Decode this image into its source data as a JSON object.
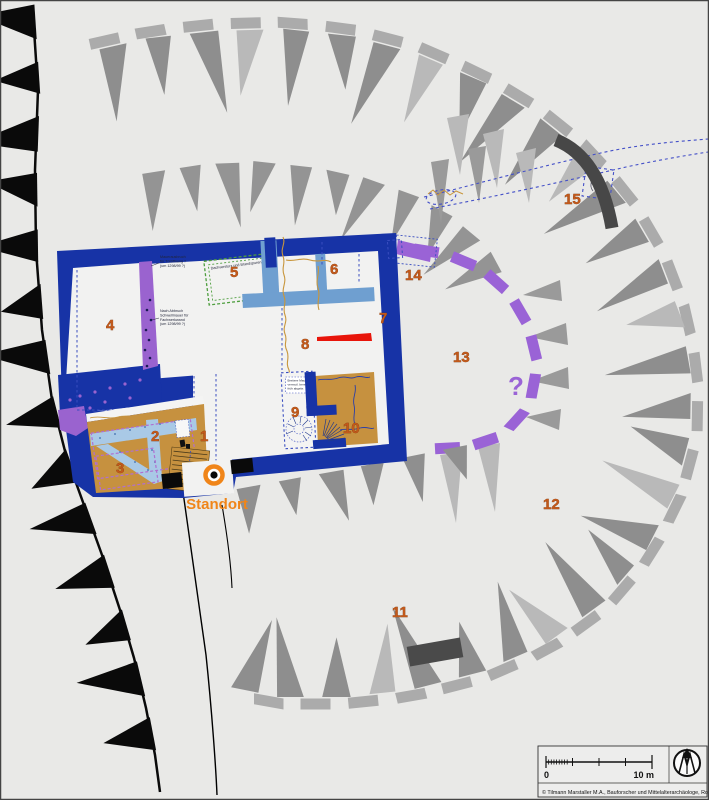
{
  "map": {
    "background_color": "#e9e9e7",
    "colors": {
      "building_wall": "#1733a6",
      "secondary_wall": "#6f9fd0",
      "light_masonry": "#a9c9e6",
      "timber_floor": "#c6913f",
      "phase_purple": "#9a63cf",
      "ring_dash_purple": "#9a63d6",
      "red_feature": "#e8150a",
      "label_orange": "#c2591b",
      "standort_orange": "#f08519",
      "rampart_dash": "#ababab",
      "rampart_spike": "#8e8e8e",
      "rampart_spike_light": "#b9b9b9",
      "cliff_black": "#0a0a0a",
      "dark_wall_segment": "#474747",
      "trench_blue_dash": "#3a4ec0",
      "green_outline": "#4e9e3e",
      "old_wall_ochre": "#c8963c"
    },
    "area_labels": [
      {
        "label": "1"
      },
      {
        "label": "2"
      },
      {
        "label": "3"
      },
      {
        "label": "4"
      },
      {
        "label": "5"
      },
      {
        "label": "6"
      },
      {
        "label": "7"
      },
      {
        "label": "8"
      },
      {
        "label": "9"
      },
      {
        "label": "10"
      },
      {
        "label": "11"
      },
      {
        "label": "12"
      },
      {
        "label": "13"
      },
      {
        "label": "14"
      },
      {
        "label": "15"
      }
    ],
    "question_mark": "?",
    "standort_label": "Standort",
    "annotations": {
      "a1": {
        "lines": [
          "Mauerausbruch",
          "für Türöffnung ?",
          "(um 1298/99 ?)"
        ]
      },
      "a2": {
        "lines": [
          "Nach Abbruch",
          "Schwellmauer für",
          "Fachwerkwand",
          "(um 1298/99 ?)"
        ]
      },
      "a3": {
        "text": "Dachversturz und Brandspuren"
      },
      "a4": {
        "lines": [
          "Breitere Mauer",
          "vermutl. bereits",
          "früh abgebr."
        ]
      }
    },
    "legend": {
      "scale_zero": "0",
      "scale_ten": "10 m",
      "credit": "© Tilmann Marstaller M.A., Bauforscher und Mittelalterarchäologe, Rottenburg 2006"
    }
  }
}
